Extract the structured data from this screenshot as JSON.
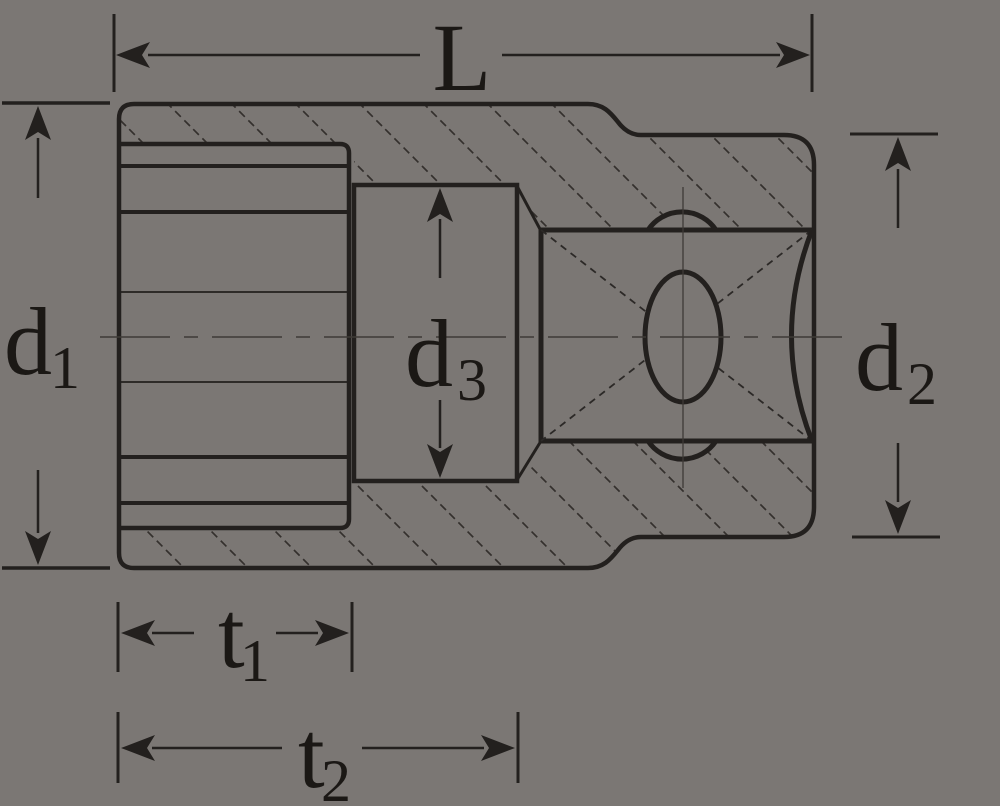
{
  "title": "Socket wrench cross-section dimensional drawing",
  "colors": {
    "background": "#7b7774",
    "line": "#23201e",
    "hatch": "#34302d",
    "text": "#1b1815"
  },
  "dimensions": {
    "length": {
      "main": "L",
      "sub": ""
    },
    "d1": {
      "main": "d",
      "sub": "1"
    },
    "d2": {
      "main": "d",
      "sub": "2"
    },
    "d3": {
      "main": "d",
      "sub": "3"
    },
    "t1": {
      "main": "t",
      "sub": "1"
    },
    "t2": {
      "main": "t",
      "sub": "2"
    }
  }
}
